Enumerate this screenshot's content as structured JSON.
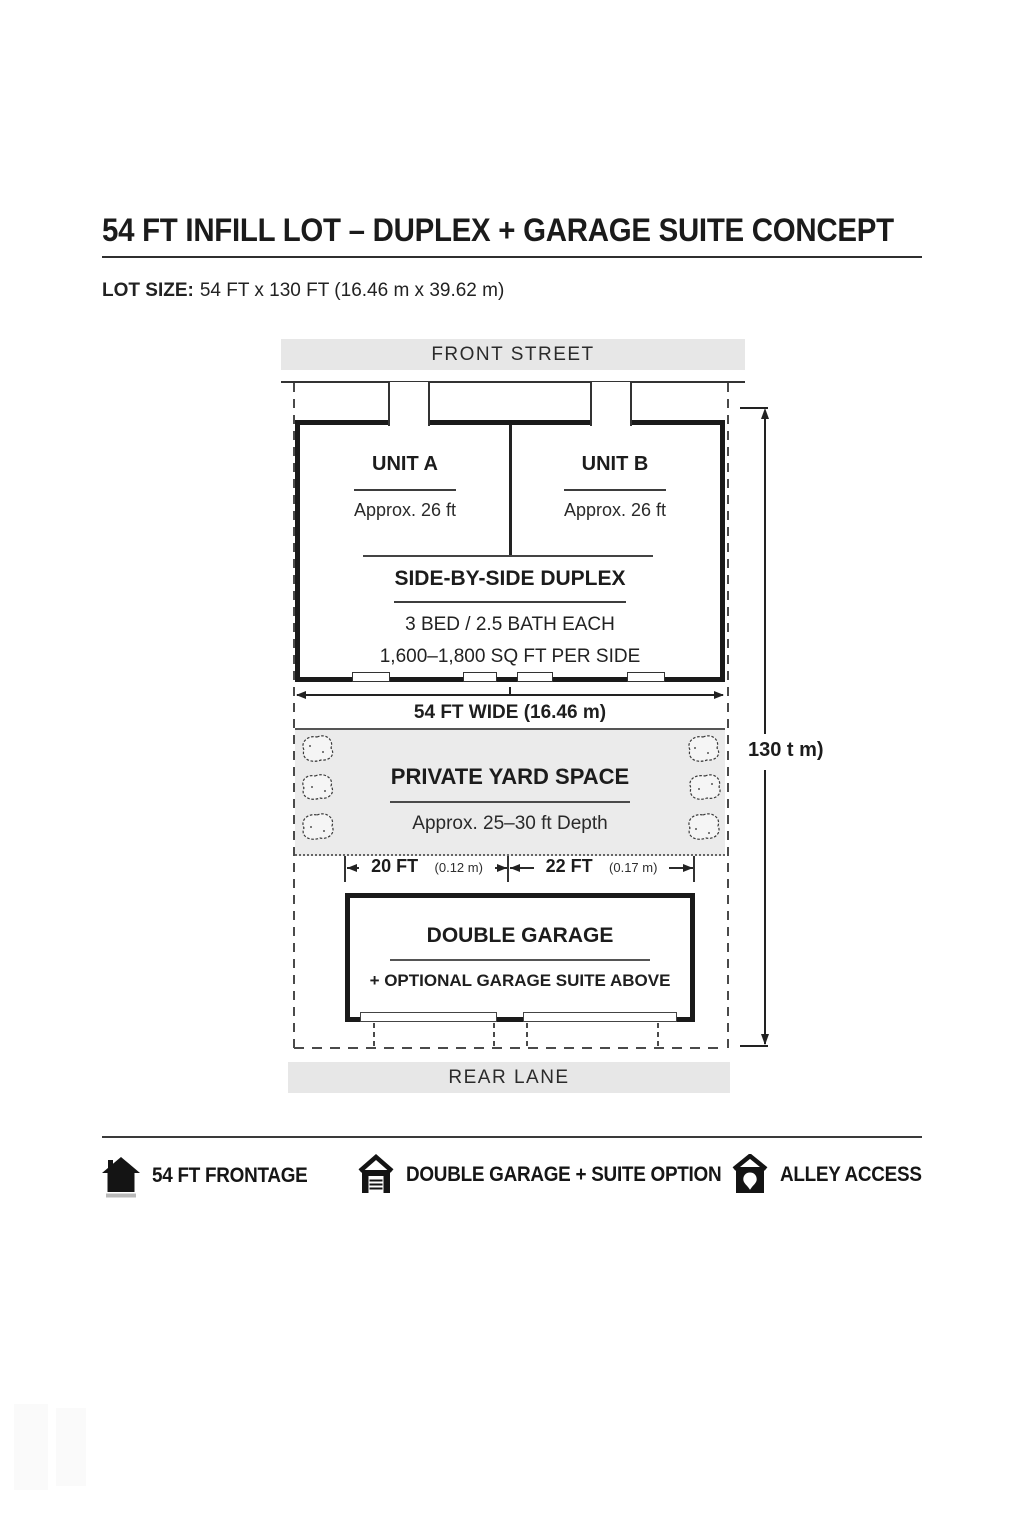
{
  "header": {
    "title": "54 FT INFILL LOT – DUPLEX + GARAGE SUITE CONCEPT",
    "lot_size_label": "LOT SIZE:",
    "lot_size_value": "54 FT x 130 FT (16.46 m x 39.62 m)"
  },
  "plan": {
    "front_street_label": "FRONT STREET",
    "rear_lane_label": "REAR LANE",
    "duplex": {
      "unit_a_name": "UNIT A",
      "unit_a_width": "Approx. 26 ft",
      "unit_b_name": "UNIT B",
      "unit_b_width": "Approx. 26 ft",
      "type_label": "SIDE-BY-SIDE DUPLEX",
      "bed_bath": "3 BED / 2.5 BATH EACH",
      "area": "1,600–1,800 SQ FT PER SIDE"
    },
    "yard": {
      "name": "PRIVATE YARD SPACE",
      "depth": "Approx. 25–30 ft Depth"
    },
    "garage": {
      "name": "DOUBLE GARAGE",
      "suite_option": "+ OPTIONAL GARAGE SUITE ABOVE"
    },
    "dims": {
      "lot_width": "54 FT WIDE (16.46 m)",
      "lot_depth": "130 t m)",
      "garage_bay_left": "20 FT",
      "garage_bay_left_metric": "(0.12 m)",
      "garage_bay_right": "22 FT",
      "garage_bay_right_metric": "(0.17 m)"
    }
  },
  "legend": {
    "items": [
      {
        "icon": "frontage-house-icon",
        "label": "54 FT FRONTAGE"
      },
      {
        "icon": "double-garage-icon",
        "label": "DOUBLE GARAGE + SUITE OPTION"
      },
      {
        "icon": "alley-access-icon",
        "label": "ALLEY ACCESS"
      }
    ]
  },
  "colors": {
    "ink": "#1d1d1d",
    "wall": "#1a1a1a",
    "banner_bg": "#e7e7e7",
    "yard_bg": "#ebebeb",
    "base_bar": "#b9b9b9"
  }
}
